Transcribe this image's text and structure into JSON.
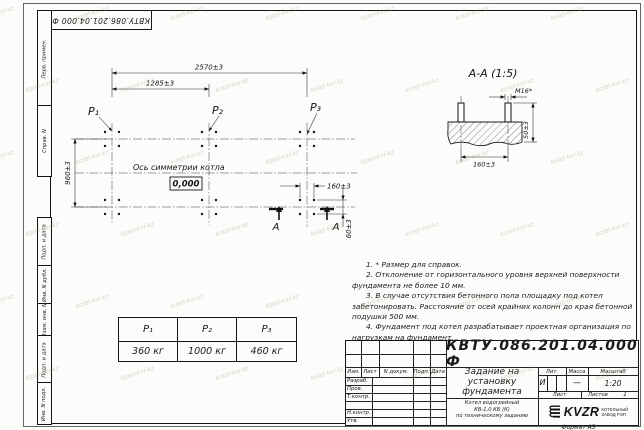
{
  "sheet": {
    "doc_number": "КВТУ.086.201.04.000  Ф",
    "format_label": "Формат А3",
    "watermark_text": "kotel-kvr.kz"
  },
  "sidebar": {
    "fields": [
      "Перв. примен.",
      "Справ. N",
      "Подп. и дата",
      "Инв. N дубл.",
      "Взам. инв. N",
      "Подп. и дата",
      "Инв. N подл."
    ]
  },
  "plan": {
    "dim_2570": "2570±3",
    "dim_1285": "1285±3",
    "dim_960": "960±3",
    "dim_160_h": "160±3",
    "dim_160_v": "160±3",
    "p1": "P₁",
    "p2": "P₂",
    "p3": "P₃",
    "axis_label": "Ось симметрии котла",
    "elevation": "0,000",
    "section_letter": "А"
  },
  "section": {
    "title": "А-А (1:5)",
    "bolt_label": "М16*",
    "dim_50": "50±3",
    "dim_160": "160±3"
  },
  "notes": [
    "1. * Размер для справок.",
    "2. Отклонение от горизонтального уровня верхней поверхности фундамента не более 10 мм.",
    "3. В случае отсутствия бетонного пола площадку под котел забетонировать. Расстояние от осей крайних колонн до края бетонной подушки 500 мм.",
    "4. Фундамент под котел разрабатывает проектная организация по нагрузкам на фундамент."
  ],
  "load_table": {
    "headers": [
      "P₁",
      "P₂",
      "P₃"
    ],
    "values": [
      "360 кг",
      "1000 кг",
      "460 кг"
    ]
  },
  "title_block": {
    "columns": {
      "izm": "Изм.",
      "list": "Лист",
      "doc": "N докум.",
      "podp": "Подп.",
      "data": "Дата"
    },
    "rows": [
      "Разраб.",
      "Пров.",
      "Т.контр.",
      "Н.контр.",
      "Утв."
    ],
    "title_lines": [
      "Задание на",
      "установку",
      "фундамента"
    ],
    "subtitle_lines": [
      "Котел водогрейный",
      "КВ-1,0 КБ (К)",
      "по техническому заданию"
    ],
    "lit_label": "Лит.",
    "lit_value": "И",
    "mass_label": "Масса",
    "mass_value": "—",
    "scale_label": "Масштаб",
    "scale_value": "1:20",
    "sheet_label": "Лист",
    "sheets_label": "Листов",
    "sheets_value": "1",
    "logo_text": "KVZR",
    "logo_caption_lines": [
      "КОТЕЛЬНЫЙ",
      "ЗАВОД РЭП"
    ]
  }
}
